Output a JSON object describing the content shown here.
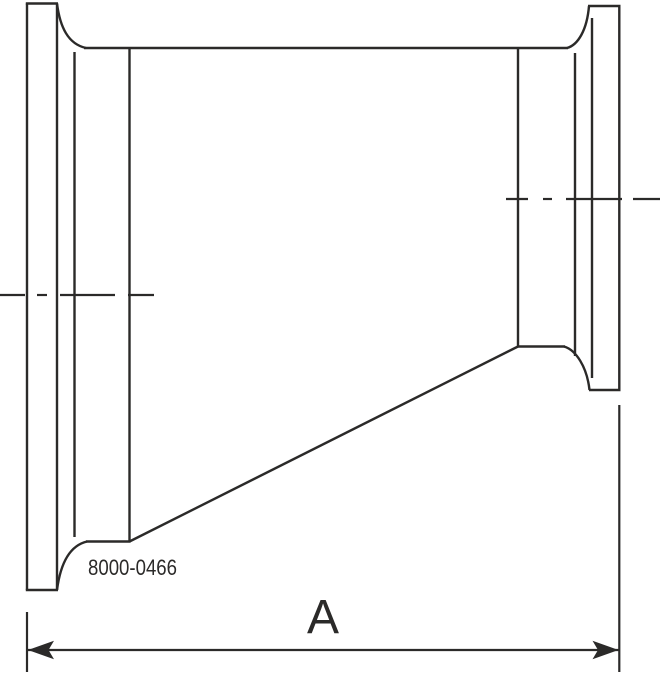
{
  "page": {
    "background": "#ffffff"
  },
  "drawing": {
    "part_number": "8000-0466",
    "dimension_label": "A",
    "line_color": "#2b2a29",
    "canvas": {
      "width": 660,
      "height": 674
    },
    "stroke": {
      "object": 2.4,
      "centerline": 2.2,
      "dimension": 2.2
    },
    "geometry": {
      "object_lines": [
        [
          27,
          3.5,
          27,
          590
        ],
        [
          25.8,
          3.5,
          58,
          3.5
        ],
        [
          57,
          3.5,
          57,
          590
        ],
        [
          25.8,
          590,
          58,
          590
        ],
        [
          74.5,
          52,
          74.5,
          537
        ],
        [
          129.5,
          48,
          129.5,
          541.5
        ],
        [
          84,
          48,
          568,
          48
        ],
        [
          86,
          541.5,
          130.5,
          541.5
        ],
        [
          129.5,
          541.5,
          518,
          346.5
        ],
        [
          518,
          48,
          518,
          346.5
        ],
        [
          517,
          346.5,
          565,
          346.5
        ],
        [
          575,
          53,
          575,
          356
        ],
        [
          592,
          18,
          592,
          378
        ],
        [
          619.3,
          6,
          619.3,
          390
        ],
        [
          588,
          6,
          620.5,
          6
        ],
        [
          589,
          390,
          620.5,
          390
        ]
      ],
      "neck_curves": [
        "M57,3.5 C60,27 68,44 86,48",
        "M57,590 C60,567 68,546 87,541.5",
        "M567,48 C578,45 587,30 589,6",
        "M564,346.5 C576,350 587,367 589.5,390"
      ],
      "centerlines": [
        {
          "y": 295,
          "dashes": [
            [
              0,
              25
            ],
            [
              37,
              47
            ],
            [
              60,
              115
            ],
            [
              128,
              154
            ]
          ]
        },
        {
          "y": 199,
          "dashes": [
            [
              506,
              528
            ],
            [
              543,
              552
            ],
            [
              566,
              622
            ],
            [
              633,
              660
            ]
          ]
        }
      ],
      "dimension": {
        "extension_lines": [
          [
            27,
            612,
            27,
            672
          ],
          [
            619.3,
            405,
            619.3,
            672
          ]
        ],
        "line": [
          28,
          650,
          618.5,
          650
        ],
        "arrowheads": [
          "28,650 54,640.8 48.5,650 54,659.2",
          "618.5,650 592.5,640.8 598,650 592.5,659.2"
        ]
      }
    }
  }
}
